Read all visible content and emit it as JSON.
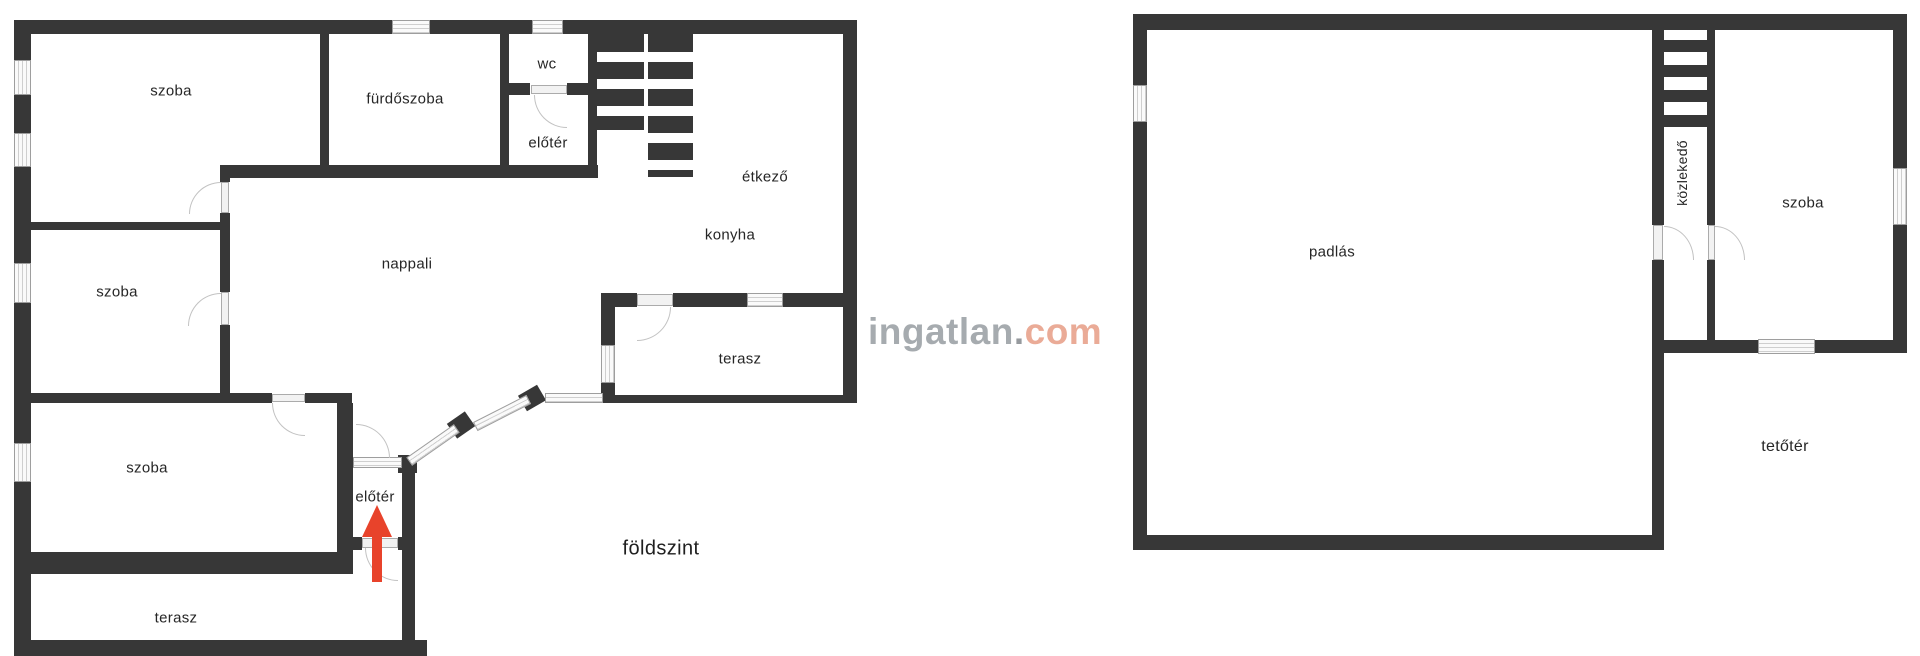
{
  "watermark": {
    "brand": "ingatlan",
    "dot": ".",
    "tld": "com"
  },
  "colors": {
    "wall": "#373737",
    "arrow": "#e8432b",
    "watermark_brand": "#a6abaf",
    "watermark_tld": "#eaab97"
  },
  "floors": {
    "ground": {
      "name": "földszint",
      "rooms": {
        "szoba_top": "szoba",
        "furdoszoba": "fürdőszoba",
        "wc": "wc",
        "eloter_top": "előtér",
        "etkezo": "étkező",
        "konyha": "konyha",
        "nappali": "nappali",
        "szoba_mid": "szoba",
        "terasz_mid": "terasz",
        "szoba_bottom": "szoba",
        "eloter_entry": "előtér",
        "terasz_bottom": "terasz"
      }
    },
    "attic": {
      "name": "tetőtér",
      "rooms": {
        "padlas": "padlás",
        "kozlekedo": "közlekedő",
        "szoba": "szoba"
      }
    }
  }
}
